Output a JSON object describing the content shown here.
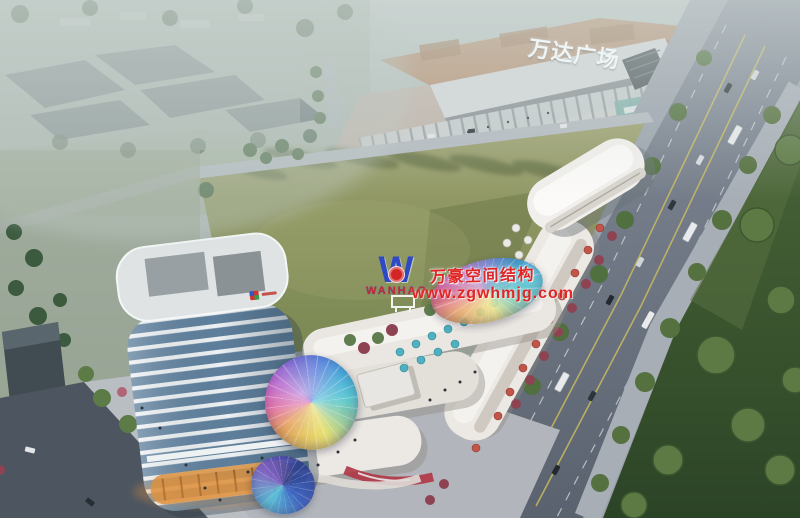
{
  "scene": {
    "description": "Dusk aerial rendering of a mixed-use commercial plaza: a white streamline high-rise tower on a curved retail podium with iridescent glass domes, an oval white pavilion, a large green infill lot, the Wanda Plaza mall behind, and a tree-lined boulevard with traffic on the right.",
    "time_of_day": "dusk, hazy"
  },
  "signage": {
    "mall_sign": "万达广场"
  },
  "watermark": {
    "logo_letter": "W",
    "logo_text": "WANHAO",
    "title": "万豪空间结构",
    "url": "www.zgwhmjg.com",
    "logo_color": "#2d49c6",
    "text_color": "#e02525"
  },
  "palette": {
    "haze": "#b7c2bf",
    "field_green": "#94976a",
    "lawn_dark": "#3c5430",
    "road_grey": "#6f7885",
    "tower_glass": "#5e7f9c",
    "tower_band": "#eef2f4",
    "dome_iridescent": [
      "#e8c860",
      "#e060a0",
      "#6858d0",
      "#40a8d8",
      "#58c8d0"
    ],
    "umbrella_teal": "#4fb0bf",
    "umbrella_red": "#c05548",
    "storefront_glow": "#d99040"
  }
}
